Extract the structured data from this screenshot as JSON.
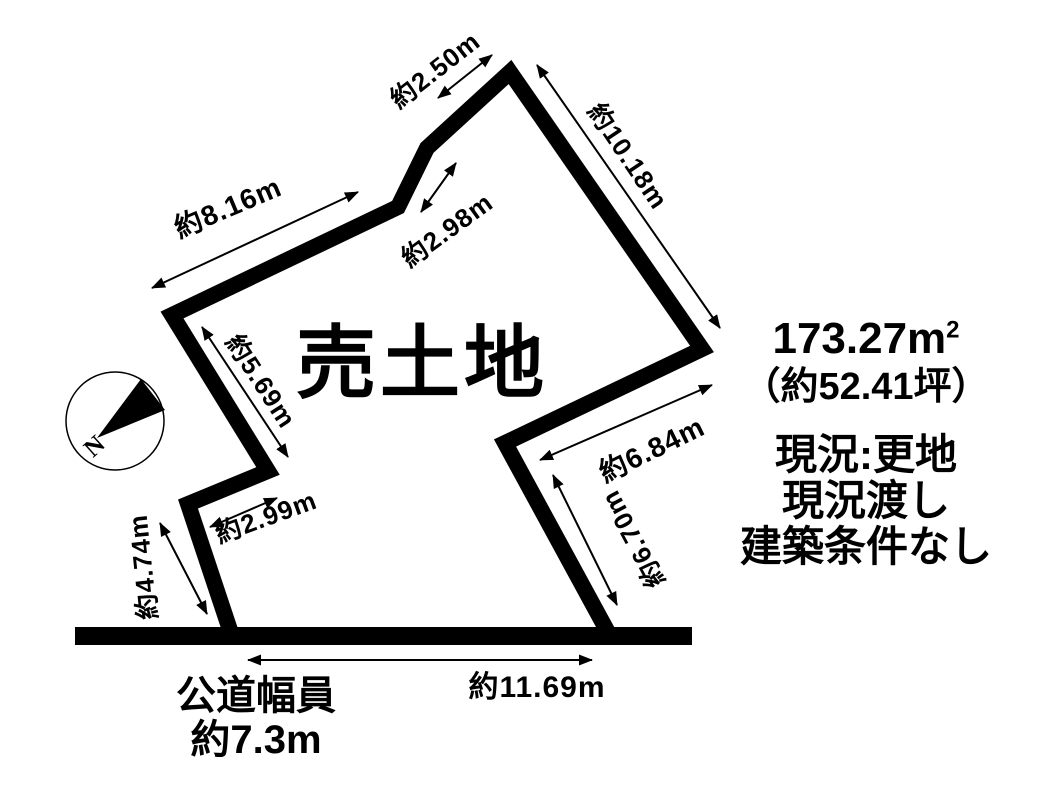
{
  "diagram": {
    "title": "売土地",
    "kind": "land-plot-sale-diagram",
    "ink_color": "#000000",
    "background_color": "#ffffff"
  },
  "compass": {
    "label": "N"
  },
  "dimensions": {
    "top_short": {
      "label": "約2.50m"
    },
    "right_upper": {
      "label": "約10.18m"
    },
    "upper_left": {
      "label": "約8.16m"
    },
    "top_bend": {
      "label": "約2.98m"
    },
    "left_upper": {
      "label": "約5.69m"
    },
    "notch": {
      "label": "約2.99m"
    },
    "left_lower": {
      "label": "約4.74m"
    },
    "right_inner": {
      "label": "約6.84m"
    },
    "right_lower": {
      "label": "約6.70m"
    },
    "frontage": {
      "label": "約11.69m"
    }
  },
  "info": {
    "area_value": "173.27m",
    "area_sup": "2",
    "area_tsubo": "（約52.41坪）",
    "condition_1": "現況:更地",
    "condition_2": "現況渡し",
    "condition_3": "建築条件なし"
  },
  "road": {
    "line1": "公道幅員",
    "line2": "約7.3m"
  }
}
